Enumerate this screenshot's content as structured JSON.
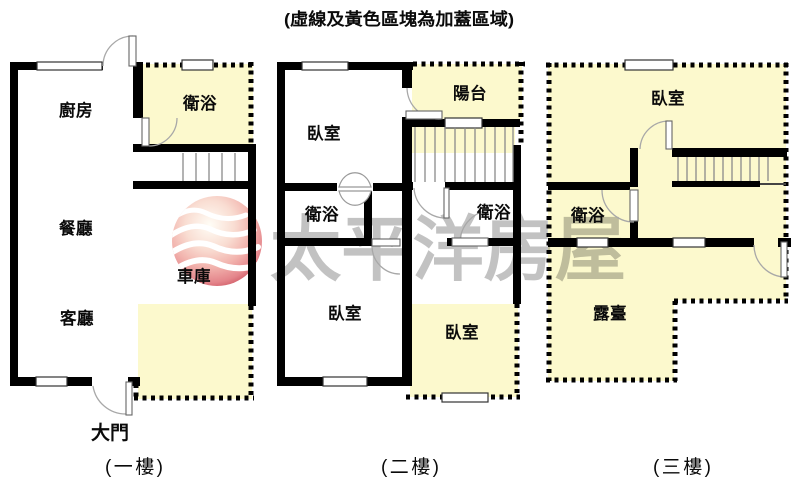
{
  "title": "(虛線及黃色區塊為加蓋區域)",
  "watermark": {
    "brand_text": "太平洋房屋",
    "logo": "pacific-wave-sphere-logo"
  },
  "colors": {
    "addition_fill": "#FCF9CD",
    "wall_black": "#000000",
    "stair_line_gray": "#8a8a8a",
    "watermark_text": "rgba(0,0,0,0.24)",
    "logo_red_dark": "#c2404e",
    "logo_pink": "#f2b4ae"
  },
  "floors": [
    {
      "name": "(一樓)",
      "entrance_label": "大門",
      "rooms": {
        "kitchen": "廚房",
        "bathroom": "衛浴",
        "dining": "餐廳",
        "garage": "車庫",
        "living": "客廳"
      }
    },
    {
      "name": "(二樓)",
      "rooms": {
        "bedroom_top": "臥室",
        "balcony": "陽台",
        "bathroom_left": "衛浴",
        "bathroom_right": "衛浴",
        "bedroom_bottom_left": "臥室",
        "bedroom_bottom_right": "臥室"
      }
    },
    {
      "name": "(三樓)",
      "rooms": {
        "bedroom": "臥室",
        "bathroom": "衛浴",
        "terrace": "露臺"
      }
    }
  ]
}
